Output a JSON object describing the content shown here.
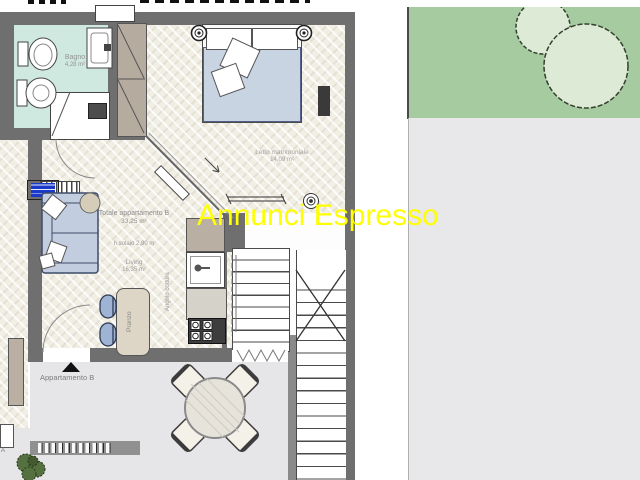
{
  "watermark": {
    "text": "Annunci Espresso",
    "color": "#feff00"
  },
  "labels": {
    "bagno": {
      "name": "Bagno",
      "area": "4,28 m²"
    },
    "letto": {
      "name": "Letto matrimoniale",
      "area": "14,09 m²"
    },
    "totale": {
      "name": "Totale appartamento B",
      "area": "33,25 m²"
    },
    "solaio": {
      "name": "h solaio 2,80 m"
    },
    "living": {
      "name": "Living",
      "area": "16,35 m²"
    },
    "angolo_cottura": {
      "name": "Angolo cottura"
    },
    "pranzo": {
      "name": "Pranzo"
    },
    "appartamento_b": {
      "name": "Appartamento B"
    },
    "appartamento_a_fragment": {
      "name": "A"
    }
  },
  "colors": {
    "wall": "#6f6f6f",
    "bathroom_floor": "#cfe9e1",
    "parquet": "#f1eee4",
    "garden": "#a7cba1",
    "tree_canopy": "#dcead6",
    "paving": "#e8e8ea",
    "sofa": "#c2cde0",
    "bed_duvet": "#c9d4e3",
    "wardrobe": "#b5ab9f",
    "note_badge": "#1b39c9",
    "watermark": "#feff00"
  }
}
